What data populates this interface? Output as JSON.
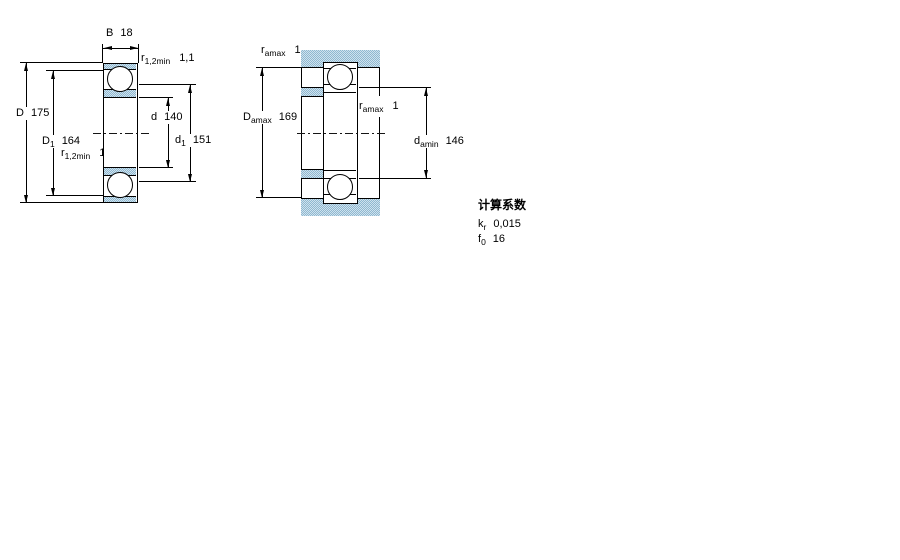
{
  "left_view": {
    "B": {
      "label": "B",
      "value": "18"
    },
    "D": {
      "label": "D",
      "value": "175"
    },
    "D1": {
      "label": "D",
      "sub": "1",
      "value": "164"
    },
    "d": {
      "label": "d",
      "value": "140"
    },
    "d1": {
      "label": "d",
      "sub": "1",
      "value": "151"
    },
    "r_top": {
      "label": "r",
      "sub": "1,2min",
      "value": "1,1"
    },
    "r_bottom": {
      "label": "r",
      "sub": "1,2min",
      "value": "1,1"
    }
  },
  "right_view": {
    "ra_top": {
      "label": "r",
      "sub": "amax",
      "value": "1"
    },
    "ra_inner": {
      "label": "r",
      "sub": "amax",
      "value": "1"
    },
    "Da": {
      "label": "D",
      "sub": "amax",
      "value": "169"
    },
    "da": {
      "label": "d",
      "sub": "amin",
      "value": "146"
    }
  },
  "factors": {
    "title": "计算系数",
    "kr": {
      "label": "k",
      "sub": "r",
      "value": "0,015"
    },
    "f0": {
      "label": "f",
      "sub": "0",
      "value": "16"
    }
  },
  "colors": {
    "ring_fill_dark": "#8fb8d0",
    "ring_fill_light": "#cfe2ee",
    "line": "#000000"
  }
}
